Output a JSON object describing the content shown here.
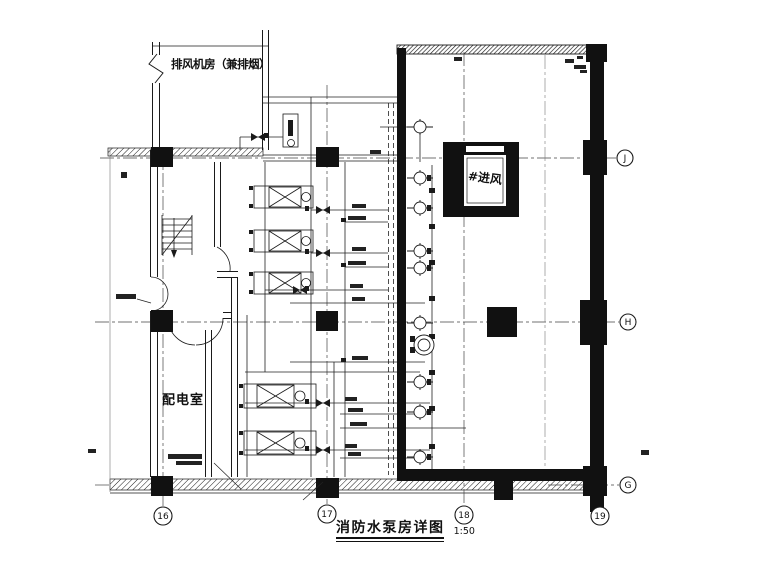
{
  "drawing": {
    "colors": {
      "background": "#ffffff",
      "ink": "#1a1a1a"
    },
    "rooms": {
      "exhaust_fan_room_label": "排风机房（兼排烟）",
      "power_distribution_room_label": "配电室",
      "air_intake_shaft_label": "#进风"
    },
    "title_block": {
      "title": "消防水泵房详图",
      "scale": "1:50"
    },
    "grid": {
      "columns": [
        {
          "label": "16"
        },
        {
          "label": "17"
        },
        {
          "label": "18"
        },
        {
          "label": "19"
        }
      ],
      "rows": [
        {
          "label": "J"
        },
        {
          "label": "H"
        },
        {
          "label": "G"
        }
      ]
    }
  }
}
